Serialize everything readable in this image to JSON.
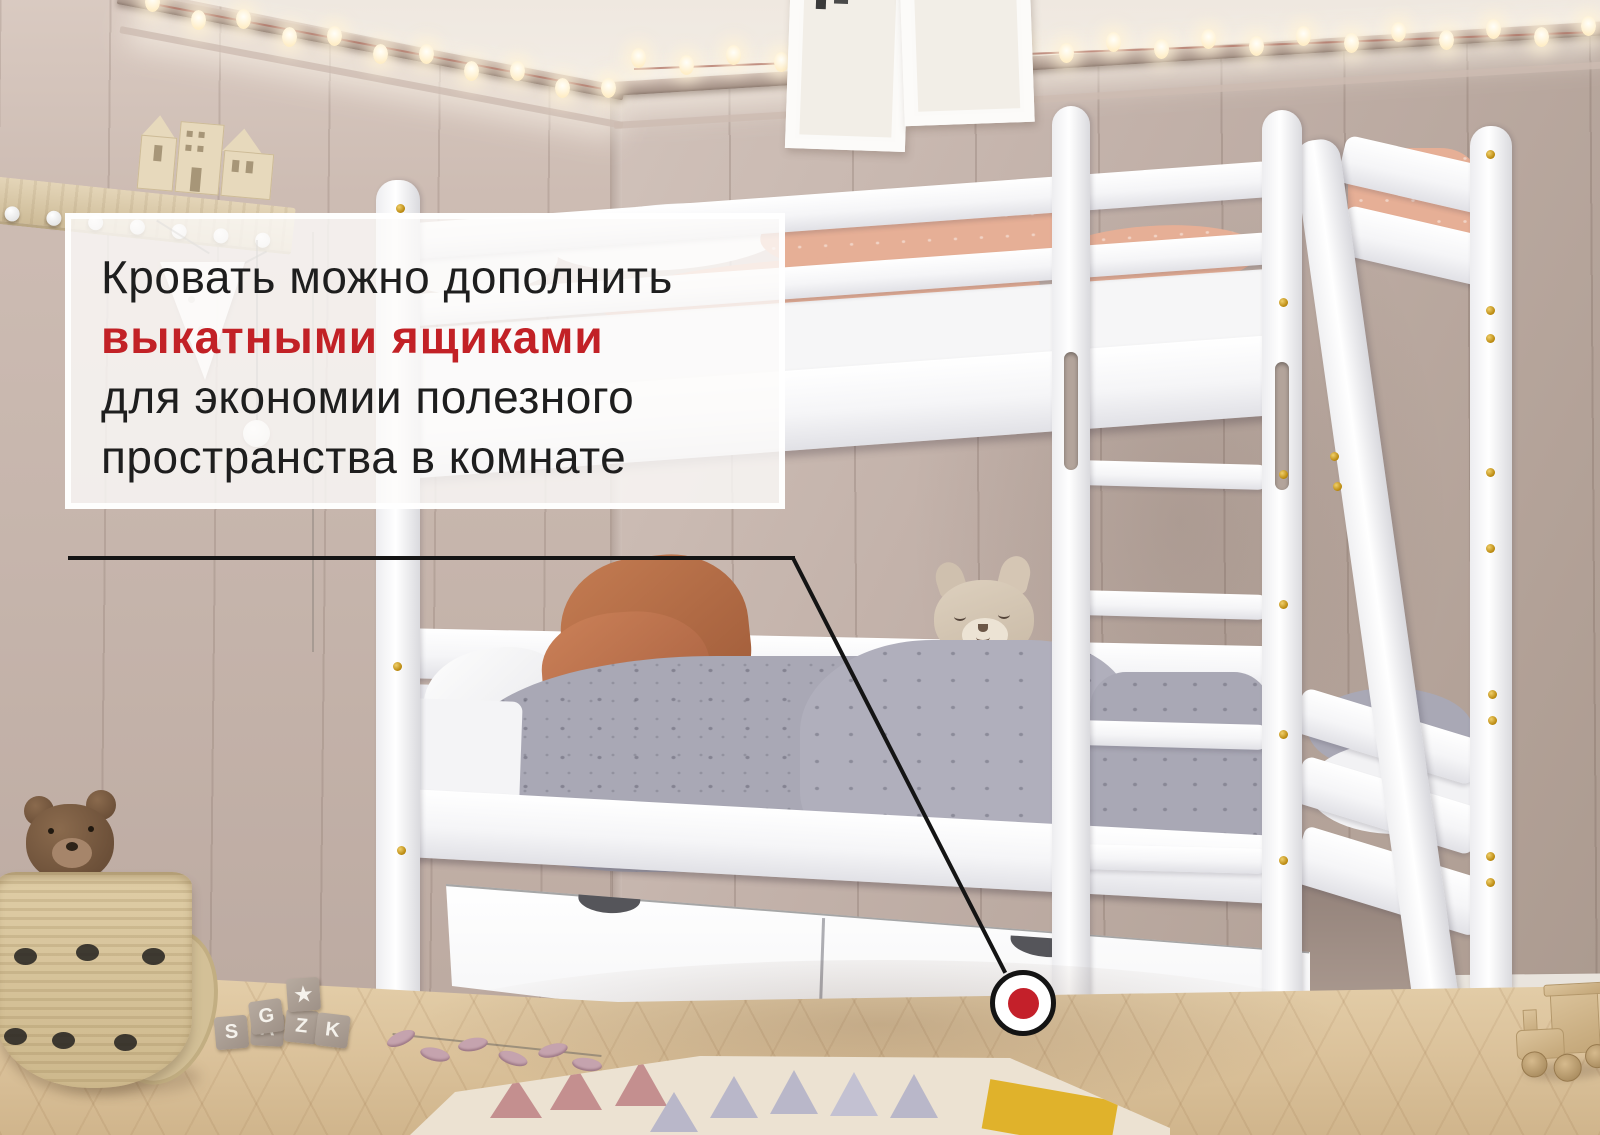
{
  "annotation": {
    "line1": "Кровать можно дополнить",
    "line2": "выкатными ящиками",
    "line3": "для экономии полезного",
    "line4": "пространства в комнате",
    "highlight_color": "#c22126",
    "text_color": "#1e1e1e"
  },
  "callout": {
    "marker_color": "#c4202a",
    "line_color": "#141414"
  },
  "doll": {
    "label": "PEACE"
  },
  "blocks": [
    {
      "letter": "S"
    },
    {
      "letter": "A"
    },
    {
      "letter": "G"
    },
    {
      "letter": "Z"
    },
    {
      "letter": "★"
    },
    {
      "letter": "K"
    }
  ],
  "lights": {
    "left_count": 11,
    "right_count": 21,
    "bulb_color": "#fff6e2"
  },
  "palette": {
    "wall_left": "#c9b8af",
    "wall_right": "#b3a198",
    "floor": "#dcc39c",
    "bed": "#ffffff",
    "duvet": "#a9a8b5",
    "pillow_terracotta": "#b9714a",
    "blanket_peach": "#e6af96"
  }
}
